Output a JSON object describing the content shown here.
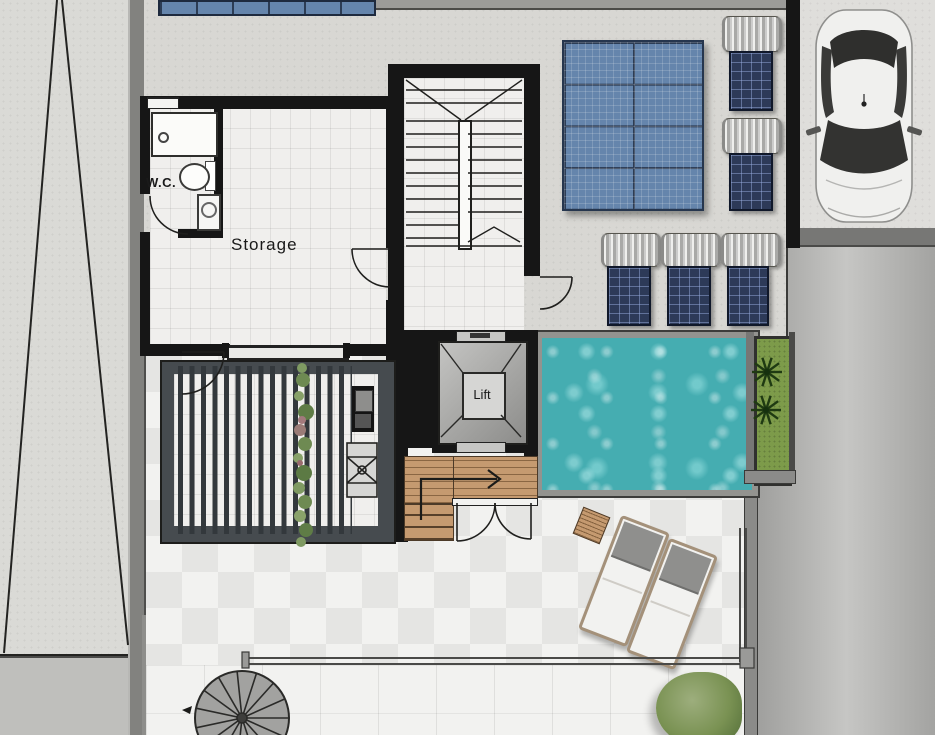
{
  "plan": {
    "type": "architectural-floor-plan",
    "labels": {
      "wc": "W.C.",
      "storage": "Storage",
      "lift": "Lift"
    },
    "colors": {
      "wall": "#161616",
      "concrete": "#d8d7d3",
      "pad": "#dfdedb",
      "tile": "#f2f2f0",
      "tile2": "#e5e5e3",
      "floor": "#f0efed",
      "pool": "#45adb1",
      "pool-light": "#96dedc",
      "solar": "#6585ac",
      "solar-dark": "#2c3c54",
      "heater": "#2d3a58",
      "wood": "#c59a70",
      "grass": "#7d9b4a",
      "palm": "#1f3a12",
      "road": "#ababa9",
      "road-light": "#c6c6c4",
      "pergola": "#464b4f",
      "slat": "#33383c",
      "line": "#232321",
      "glass": "#4a4a48",
      "tree": "#7a9253",
      "tree-light": "#9dae7d",
      "car-body": "#f0f0ee",
      "car-glass": "#333331"
    }
  }
}
